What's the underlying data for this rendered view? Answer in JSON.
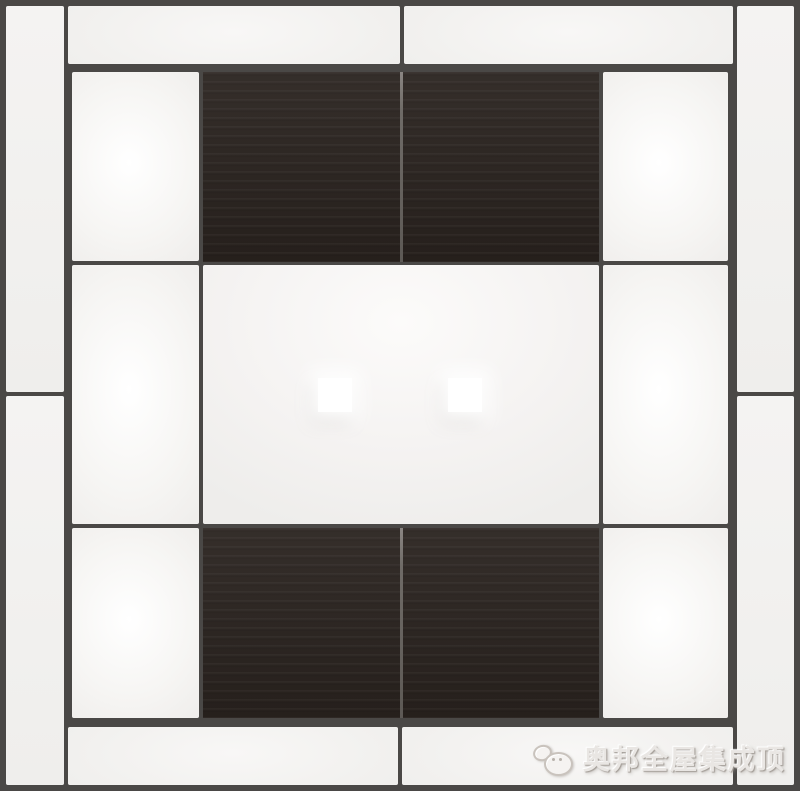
{
  "watermark": {
    "text": "奥邦全屋集成顶",
    "logo_icon": "mascot-logo-icon"
  },
  "lights": {
    "count": 2,
    "shape": "square"
  },
  "colors": {
    "background_frame": "#4a4846",
    "panel_white": "#f3f2f0",
    "panel_glow": "#ffffff",
    "wood_panel": "#2a231f",
    "wood_seam": "#6f6b67",
    "spotlight": "#ffffff",
    "watermark_text": "#e9e6e3",
    "watermark_outline": "#a39d97"
  }
}
